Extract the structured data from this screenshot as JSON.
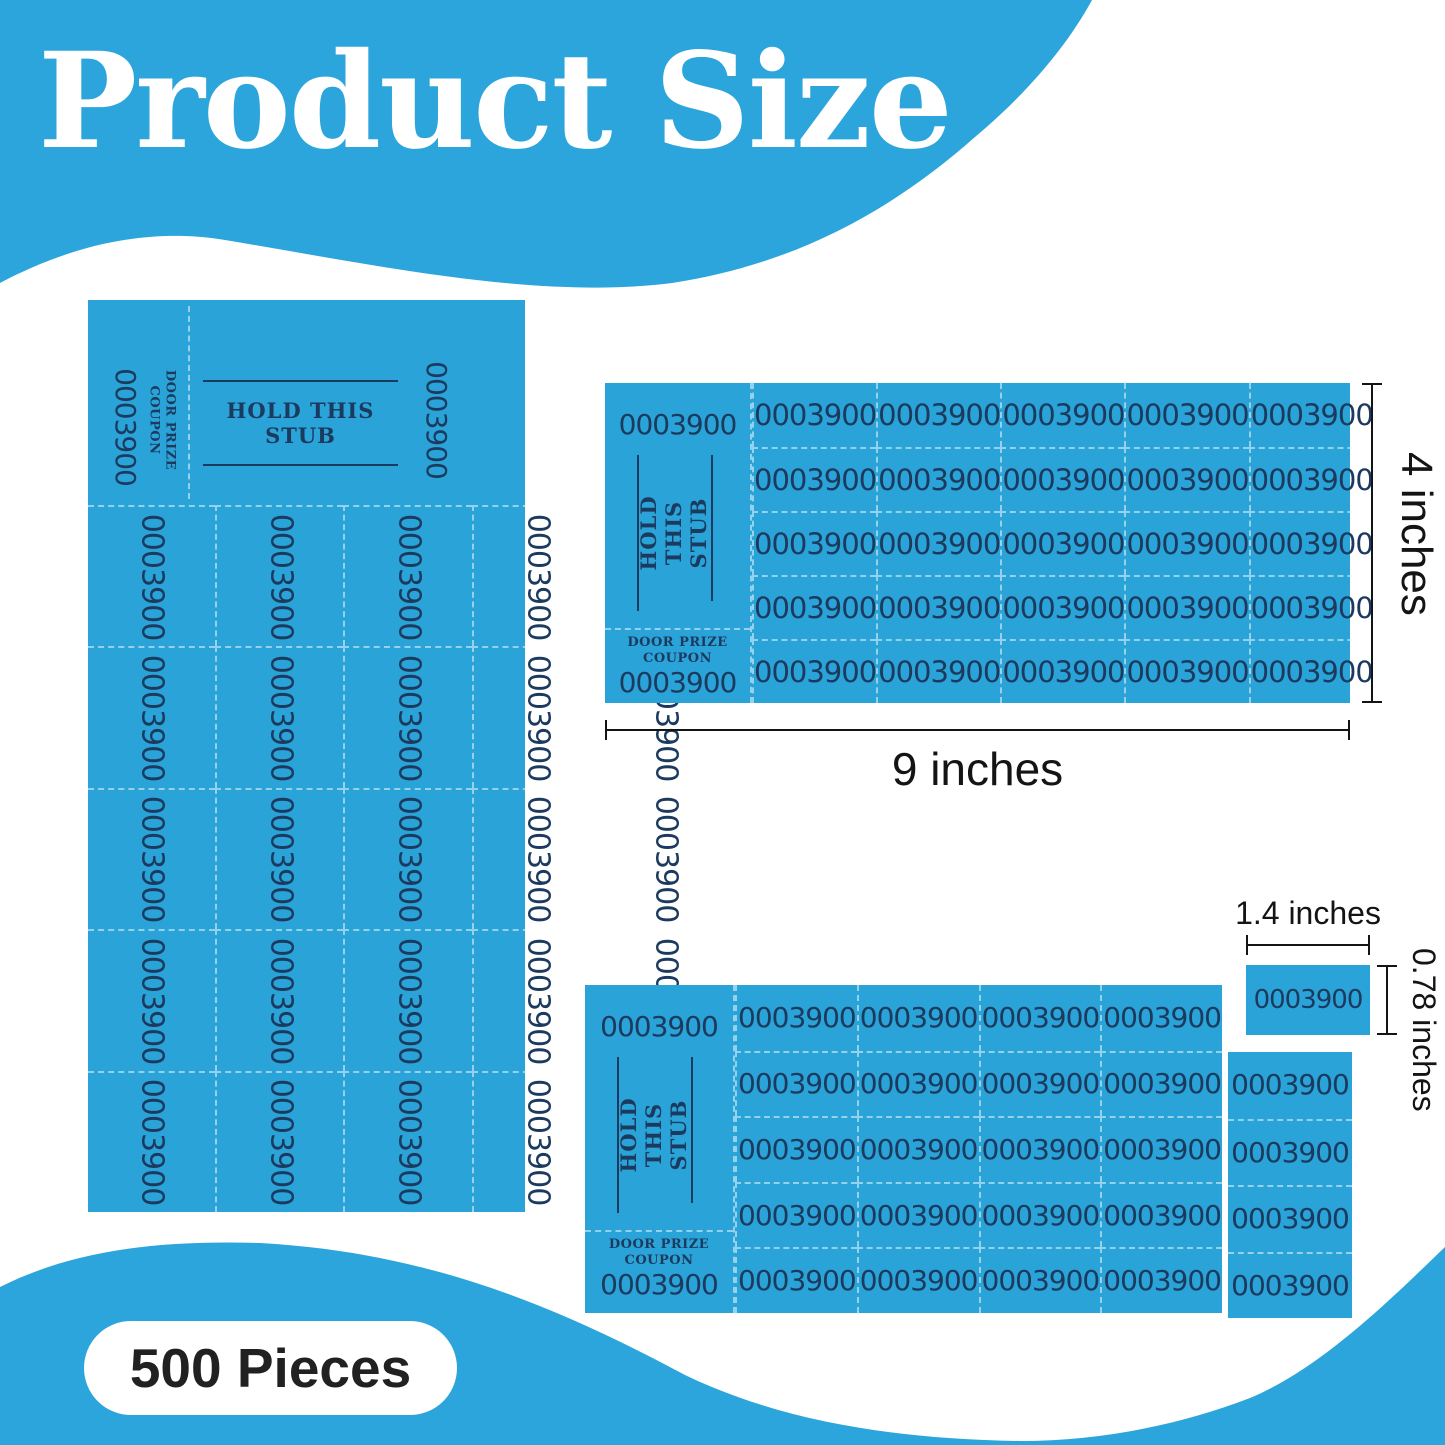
{
  "title": "Product Size",
  "pieces_label": "500 Pieces",
  "ticket": {
    "number": "0003900",
    "stub_line1": "HOLD THIS",
    "stub_line2": "STUB",
    "coupon_line1": "DOOR PRIZE",
    "coupon_line2": "COUPON"
  },
  "dimensions": {
    "sheet_width": "9 inches",
    "sheet_height": "4 inches",
    "ticket_width": "1.4 inches",
    "ticket_height": "0.78 inches"
  },
  "sheets": {
    "vertical": {
      "rows": 5,
      "cols": 5
    },
    "top": {
      "rows": 5,
      "cols": 5
    },
    "bottom_main": {
      "rows": 5,
      "cols": 4
    },
    "bottom_extra_column": {
      "rows": 4,
      "cols": 1
    }
  },
  "colors": {
    "wave_blue": "#2BA5DB",
    "ticket_blue": "#29A3D8",
    "ink_navy": "#1B3A5E",
    "dim_black": "#141414"
  }
}
